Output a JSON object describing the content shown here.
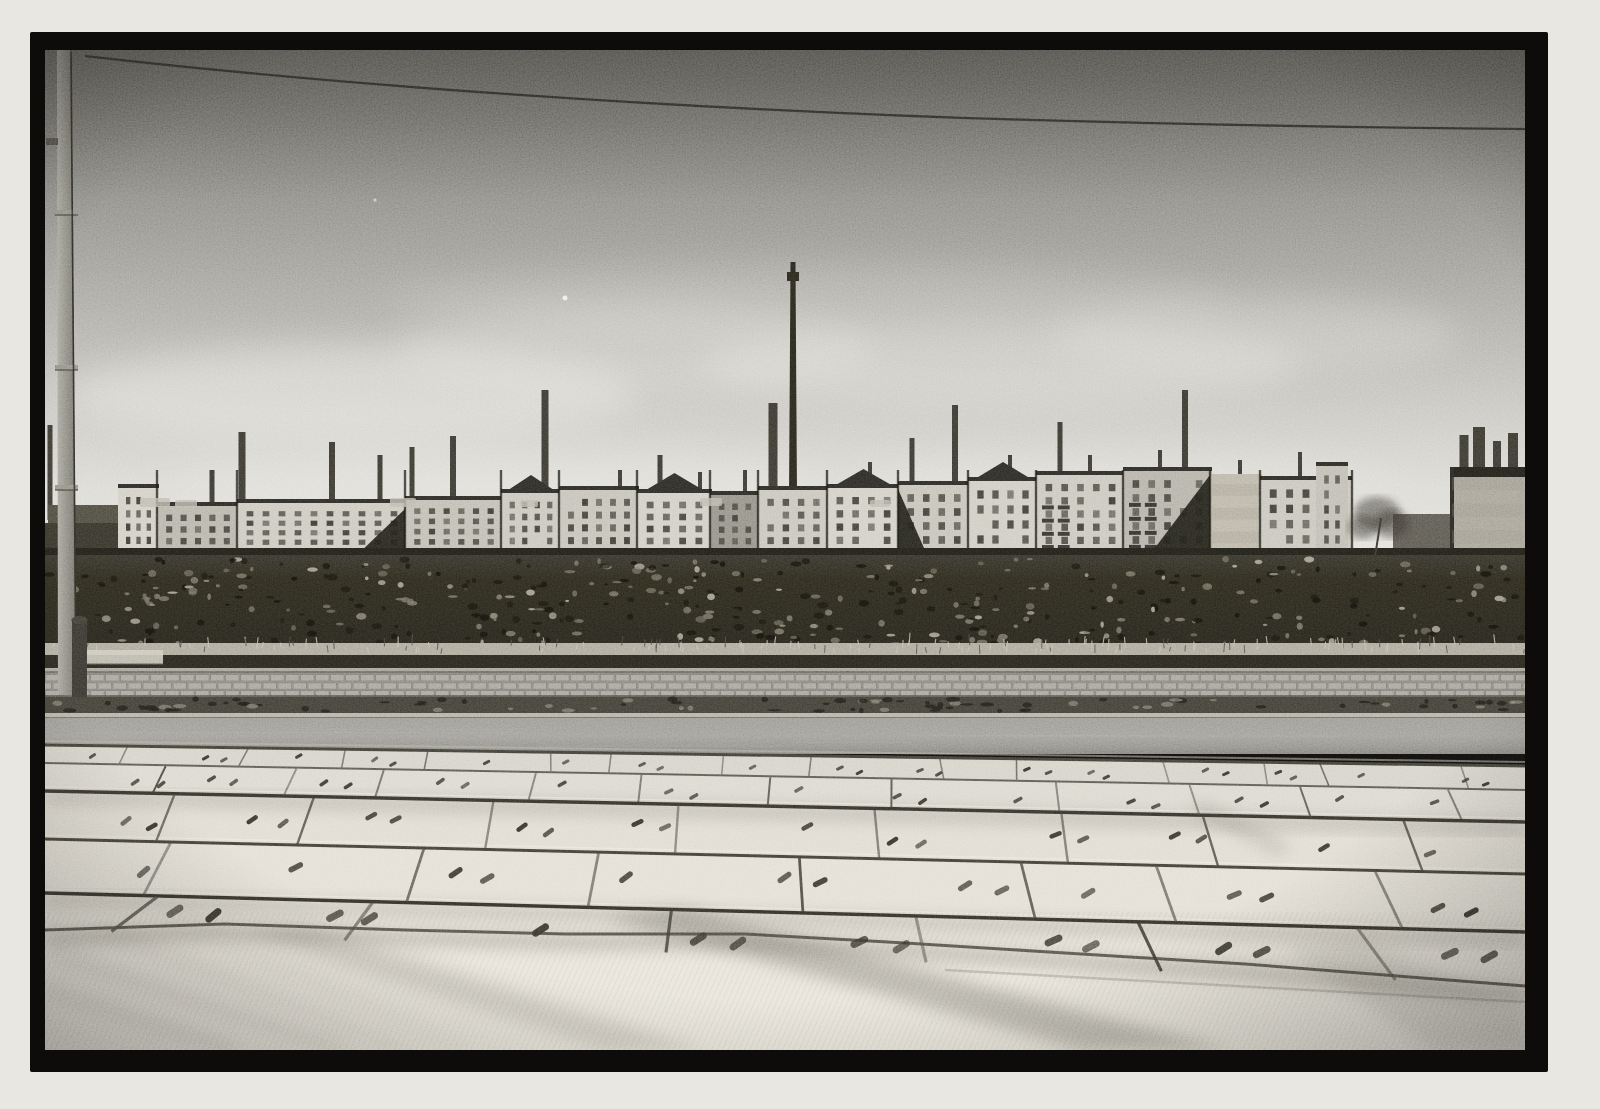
{
  "meta": {
    "kind": "black-and-white street photograph",
    "content": "row of tenement buildings with factory smokestacks behind a vacant rubble lot, cobblestone sidewalk, asphalt road and large concrete slab pavement in the foreground, utility pole at left, overhead wire across the sky"
  },
  "frame": {
    "x": 30,
    "y": 32,
    "w": 1518,
    "h": 1040,
    "photoX": 45,
    "photoY": 50,
    "photoW": 1480,
    "photoH": 1000
  },
  "scene": {
    "seed": 1234,
    "palette": {
      "paper": "#e9e7e2",
      "frame": "#0d0c0a",
      "wire": "#26251f",
      "window": "#37352d",
      "roof": "#262520",
      "stack": "#2b2922",
      "gap": "#15140f",
      "wedge": "#1b1a14",
      "ground": "#1c1b15",
      "grass": "#a8a496",
      "dark_band": "#23211a",
      "light_line": "#bab7ab",
      "cobble_base": "#8f8c84",
      "cobble_stone": "#a3a098",
      "cobble_joint": "#75726a",
      "gutter": "#3b3930",
      "curb_light": "#b0ada2",
      "curb_dark": "#2e2c25",
      "dot": "#2e2c24",
      "joint": "#44423a",
      "joint_dark": "#2f2d26",
      "smudge": "#5e5a4e",
      "shadow": "#3f3c33",
      "fg": "#e7e3d8",
      "pole_light": "#a5a399",
      "pole_dark": "#6b6960",
      "cable": "#21201b",
      "hydrant": "#32302a",
      "rail": "#ccc9bb",
      "tree": "#322f26",
      "speck_dark": "#11100b",
      "speck_mid": "#6e6a5b",
      "speck_light": "#a29d8c",
      "tuft_light": "#c2bfad",
      "tuft_dark": "#45433a",
      "debris_dark": "#1b1a14",
      "debris_light": "#9a9789",
      "patch": "#b8b5a9",
      "whitewall": "#d6d3c7",
      "highlight": "#f2efe5",
      "cloud": "#e6e5df",
      "dust": "#f4f2ea",
      "bottom_edge": "#4f4c43"
    },
    "sky": {
      "stops": [
        [
          "0%",
          "#66655f"
        ],
        [
          "12%",
          "#74736c"
        ],
        [
          "30%",
          "#8b8a84"
        ],
        [
          "50%",
          "#a8a7a1"
        ],
        [
          "70%",
          "#c6c5bf"
        ],
        [
          "85%",
          "#d9d8d2"
        ],
        [
          "100%",
          "#e2e1db"
        ]
      ],
      "clouds": [
        [
          305,
          345,
          285,
          50,
          0.5
        ],
        [
          590,
          300,
          240,
          45,
          0.32
        ],
        [
          955,
          315,
          300,
          42,
          0.38
        ],
        [
          1210,
          285,
          205,
          38,
          0.3
        ],
        [
          455,
          432,
          330,
          30,
          0.4
        ],
        [
          1080,
          430,
          280,
          26,
          0.33
        ],
        [
          760,
          250,
          420,
          34,
          0.18
        ]
      ],
      "dust": [
        [
          520,
          248,
          2.5,
          0.9
        ],
        [
          330,
          150,
          1.6,
          0.55
        ]
      ]
    },
    "wire": {
      "path": "M40,6 C320,38 640,58 920,68 C1180,76 1360,78 1480,79",
      "width": 2.3
    },
    "pole": {
      "shape": [
        [
          12,
          0
        ],
        [
          26,
          0
        ],
        [
          31,
          645
        ],
        [
          13,
          645
        ]
      ],
      "collars": [
        160,
        315,
        435
      ],
      "bracket": [
        1,
        88,
        12,
        7
      ],
      "cable": "M26,2 C28,180 30,410 31,640",
      "hydrant": [
        27,
        570,
        15,
        77
      ],
      "rail": [
        30,
        600,
        88,
        14
      ]
    },
    "stacks": [
      [
        5,
        375,
        470,
        5
      ],
      [
        167,
        420,
        470,
        5
      ],
      [
        197,
        382,
        470,
        7
      ],
      [
        287,
        392,
        470,
        6
      ],
      [
        335,
        405,
        470,
        5
      ],
      [
        367,
        397,
        470,
        5
      ],
      [
        408,
        386,
        470,
        6
      ],
      [
        500,
        340,
        460,
        7
      ],
      [
        575,
        420,
        450,
        4
      ],
      [
        615,
        405,
        450,
        5
      ],
      [
        655,
        422,
        450,
        4
      ],
      [
        700,
        420,
        450,
        4
      ],
      [
        728,
        353,
        450,
        9
      ],
      [
        825,
        412,
        445,
        4
      ],
      [
        867,
        388,
        440,
        5
      ],
      [
        910,
        355,
        440,
        6
      ],
      [
        965,
        405,
        435,
        4
      ],
      [
        1015,
        372,
        432,
        5
      ],
      [
        1045,
        405,
        430,
        4
      ],
      [
        1115,
        400,
        425,
        4
      ],
      [
        1140,
        340,
        425,
        6
      ],
      [
        1195,
        410,
        432,
        4
      ],
      [
        1255,
        402,
        435,
        4
      ],
      [
        1419,
        385,
        425,
        9
      ],
      [
        1434,
        377,
        425,
        12
      ],
      [
        1452,
        391,
        425,
        8
      ],
      [
        1468,
        383,
        425,
        10
      ]
    ],
    "tallStack": {
      "x": 743,
      "w": 10,
      "top": 212,
      "base": 445,
      "collarY": 222,
      "collarH": 9
    },
    "buildings": [
      {
        "x": 3,
        "y": 455,
        "w": 75,
        "h": 52,
        "fill": "#474439",
        "cols": 0,
        "rows": 0
      },
      {
        "x": 0,
        "y": 473,
        "w": 135,
        "h": 34,
        "fill": "#302e25",
        "cols": 0,
        "rows": 0
      },
      {
        "x": 73,
        "y": 434,
        "w": 41,
        "h": 73,
        "fill": "#cfccc2",
        "cols": 3,
        "rows": 4
      },
      {
        "x": 112,
        "y": 452,
        "w": 82,
        "h": 55,
        "fill": "#b3b0a6",
        "cols": 5,
        "rows": 3
      },
      {
        "x": 192,
        "y": 449,
        "w": 170,
        "h": 58,
        "fill": "#c9c6bc",
        "cols": 10,
        "rows": 4,
        "wedge": {
          "off": 118,
          "w": 52,
          "dir": 1
        }
      },
      {
        "x": 360,
        "y": 446,
        "w": 98,
        "h": 61,
        "fill": "#bcb9af",
        "cols": 6,
        "rows": 4
      },
      {
        "x": 456,
        "y": 439,
        "w": 60,
        "h": 68,
        "fill": "#c6c3b9",
        "cols": 4,
        "rows": 4,
        "gable": 14
      },
      {
        "x": 514,
        "y": 436,
        "w": 80,
        "h": 71,
        "fill": "#c1beb4",
        "cols": 5,
        "rows": 4
      },
      {
        "x": 592,
        "y": 439,
        "w": 75,
        "h": 68,
        "fill": "#cecbc1",
        "cols": 4,
        "rows": 4,
        "gable": 16
      },
      {
        "x": 665,
        "y": 441,
        "w": 50,
        "h": 66,
        "fill": "#8e8b81",
        "cols": 3,
        "rows": 4
      },
      {
        "x": 713,
        "y": 436,
        "w": 71,
        "h": 71,
        "fill": "#c5c2b8",
        "cols": 4,
        "rows": 4
      },
      {
        "x": 782,
        "y": 434,
        "w": 73,
        "h": 73,
        "fill": "#cfccc2",
        "cols": 4,
        "rows": 4,
        "gable": 15
      },
      {
        "x": 853,
        "y": 431,
        "w": 72,
        "h": 76,
        "fill": "#c2bfb5",
        "cols": 4,
        "rows": 4,
        "wedge": {
          "off": 0,
          "w": 30,
          "dir": -1
        }
      },
      {
        "x": 923,
        "y": 427,
        "w": 70,
        "h": 80,
        "fill": "#ccc9bf",
        "cols": 4,
        "rows": 4,
        "gable": 15
      },
      {
        "x": 991,
        "y": 421,
        "w": 89,
        "h": 86,
        "fill": "#c7c4ba",
        "cols": 5,
        "rows": 5,
        "balc": true
      },
      {
        "x": 1078,
        "y": 417,
        "w": 89,
        "h": 90,
        "fill": "#b0ada3",
        "cols": 5,
        "rows": 5,
        "balc": true,
        "wedge": {
          "off": 25,
          "w": 62,
          "dir": 1
        }
      },
      {
        "x": 1165,
        "y": 424,
        "w": 52,
        "h": 83,
        "fill": "#b8b2a3",
        "cols": 0,
        "rows": 0,
        "mottle": true
      },
      {
        "x": 1215,
        "y": 426,
        "w": 92,
        "h": 81,
        "fill": "#c5c2b8",
        "cols": 5,
        "rows": 4
      },
      {
        "x": 1271,
        "y": 412,
        "w": 32,
        "h": 95,
        "fill": "#bcb9af",
        "cols": 2,
        "rows": 5
      },
      {
        "x": 1348,
        "y": 464,
        "w": 68,
        "h": 43,
        "fill": "#55524a",
        "cols": 0,
        "rows": 0
      },
      {
        "x": 1405,
        "y": 417,
        "w": 75,
        "h": 93,
        "fill": "#a39e91",
        "cols": 0,
        "rows": 0,
        "roofBand": 10,
        "darkLeft": true,
        "mottle": true
      }
    ],
    "gaps": [
      112,
      192,
      360,
      456,
      514,
      592,
      665,
      713,
      782,
      853,
      923,
      991,
      1078,
      1165,
      1215,
      1307
    ],
    "patches": [
      [
        95,
        448,
        30,
        9
      ],
      [
        130,
        450,
        22,
        8
      ],
      [
        345,
        448,
        26,
        9
      ],
      [
        475,
        450,
        18,
        7
      ],
      [
        655,
        448,
        22,
        8
      ],
      [
        825,
        450,
        20,
        7
      ]
    ],
    "whitewall": [
      1030,
      505,
      90,
      9
    ],
    "tree": {
      "trunk": "M1330,507 L1336,468",
      "blobs": [
        [
          1332,
          463,
          23,
          16
        ],
        [
          1346,
          474,
          18,
          14
        ],
        [
          1318,
          477,
          15,
          12
        ]
      ]
    },
    "field": {
      "grassY": [
        593,
        606
      ],
      "darkY": [
        605,
        619
      ],
      "lightY": [
        618,
        622
      ],
      "speckCount": 420,
      "tuftCount": 150
    },
    "pavement": {
      "cobblesY": [
        621,
        647
      ],
      "gutterY": [
        647,
        664
      ],
      "curbY": [
        663,
        668
      ],
      "roadY": [
        668,
        704
      ],
      "debrisCount": 90
    },
    "slabs": {
      "boundaries": [
        {
          "yl": 695,
          "yr": 716,
          "w": 3,
          "c": "#3a382f",
          "hl": false
        },
        {
          "yl": 713,
          "yr": 740,
          "w": 2,
          "c": "#55524a",
          "hl": false
        },
        {
          "yl": 741,
          "yr": 772,
          "w": 3.5,
          "c": "#2e2c25",
          "hl": true
        },
        {
          "yl": 789,
          "yr": 824,
          "w": 3,
          "c": "#3a372f",
          "hl": true
        },
        {
          "yl": 843,
          "yr": 882,
          "w": 3.5,
          "c": "#2b2922",
          "hl": true
        }
      ],
      "bottom": {
        "yl": 880,
        "yr": 936
      },
      "bottomEdge": [
        [
          0,
          880
        ],
        [
          180,
          874
        ],
        [
          360,
          880
        ],
        [
          520,
          884
        ],
        [
          700,
          884
        ],
        [
          860,
          893
        ],
        [
          1020,
          903
        ],
        [
          1200,
          914
        ],
        [
          1340,
          925
        ],
        [
          1480,
          936
        ]
      ],
      "rowFills": [
        "#d3d0c6",
        "#d9d6cc",
        "#dedacf",
        "#e1ddd2",
        "#e4e0d5"
      ],
      "rows": [
        {
          "joints": 14,
          "spread": 0.012,
          "jw": 1.6,
          "dots": 16,
          "dw": 8,
          "dh": 3
        },
        {
          "joints": 11,
          "spread": 0.02,
          "jw": 2,
          "dots": 13,
          "dw": 10,
          "dh": 3.5
        },
        {
          "joints": 8,
          "spread": 0.032,
          "jw": 2.4,
          "dots": 11,
          "dw": 13,
          "dh": 4.5
        },
        {
          "joints": 7,
          "spread": 0.048,
          "jw": 2.8,
          "dots": 9,
          "dw": 16,
          "dh": 5.5
        },
        {
          "joints": 6,
          "spread": 0.07,
          "jw": 3.2,
          "dots": 8,
          "dw": 19,
          "dh": 7
        }
      ]
    },
    "shadows": {
      "bands": [
        {
          "pts": [
            [
              560,
              868
            ],
            [
              640,
              858
            ],
            [
              1185,
              1000
            ],
            [
              1040,
              1000
            ]
          ],
          "o": 0.3
        },
        {
          "pts": [
            [
              200,
              882
            ],
            [
              258,
              876
            ],
            [
              660,
              1000
            ],
            [
              560,
              1000
            ]
          ],
          "o": 0.16
        },
        {
          "pts": [
            [
              1240,
              900
            ],
            [
              1320,
              892
            ],
            [
              1480,
              960
            ],
            [
              1480,
              1000
            ],
            [
              1390,
              1000
            ]
          ],
          "o": 0.12
        }
      ],
      "streaks": [
        [
          10,
          905,
          300,
          1000,
          6,
          0.18
        ],
        [
          55,
          880,
          360,
          1000,
          4,
          0.14
        ],
        [
          0,
          940,
          190,
          1000,
          8,
          0.15
        ],
        [
          120,
          862,
          420,
          1000,
          3,
          0.12
        ],
        [
          1150,
          756,
          1240,
          800,
          12,
          0.22
        ]
      ]
    }
  }
}
